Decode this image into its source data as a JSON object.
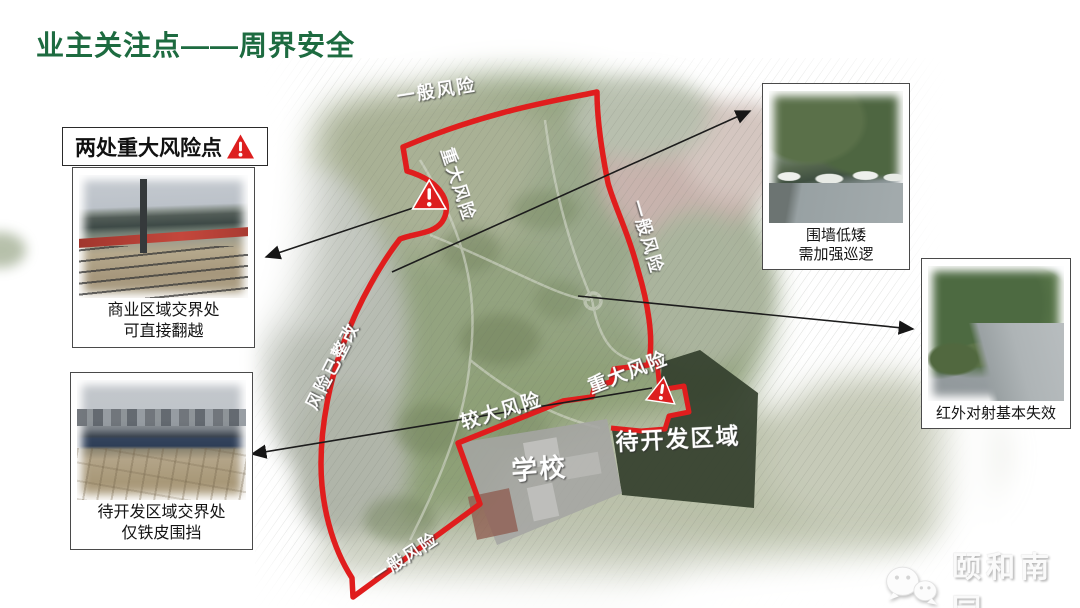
{
  "slide": {
    "title": "业主关注点——周界安全"
  },
  "risk_summary": {
    "label": "两处重大风险点",
    "icon": "warning-triangle"
  },
  "photos": {
    "commercial": {
      "caption": [
        "商业区域交界处",
        "可直接翻越"
      ]
    },
    "undeveloped": {
      "caption": [
        "待开发区域交界处",
        "仅铁皮围挡"
      ]
    },
    "low_wall": {
      "caption": [
        "围墙低矮",
        "需加强巡逻"
      ]
    },
    "infrared": {
      "caption": [
        "红外对射基本失效"
      ]
    }
  },
  "map": {
    "labels": {
      "top": "一般风险",
      "northwest": "重大风险",
      "east": "一般风险",
      "west": "风险已整改",
      "school_edge": "较大风险",
      "southeast": "重大风险",
      "south": "一般风险",
      "school": "学校",
      "undeveloped_area": "待开发区域"
    },
    "warning_icon_count": 2
  },
  "watermark": {
    "brand": "颐和南园",
    "icon": "wechat"
  },
  "colors": {
    "title_green": "#1d6b40",
    "boundary_red": "#e01d1d",
    "warning_red": "#dd1f1f"
  }
}
